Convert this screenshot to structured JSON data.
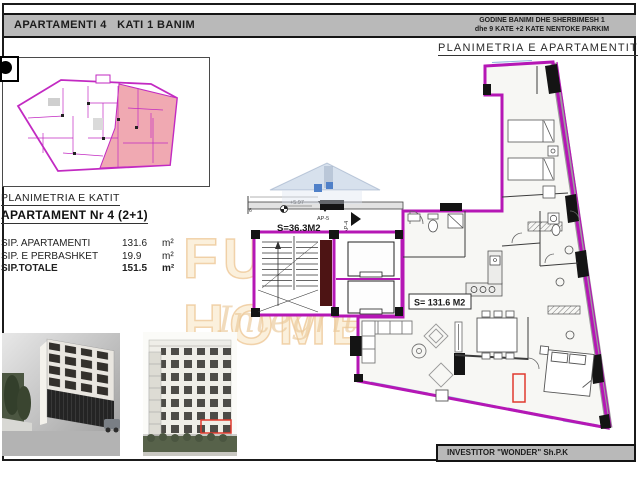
{
  "header": {
    "left_title": "APARTAMENTI 4   KATI 1 BANIM",
    "right_line1": "GODINE BANIMI DHE SHERBIMESH 1",
    "right_line2": "dhe 9 KATE +2 KATE NENTOKE PARKIM"
  },
  "titles": {
    "apartment_plan": "PLANIMETRIA E APARTAMENTIT",
    "key_plan": "PLANIMETRIA E KATIT",
    "apartment_heading": "APARTAMENT Nr 4  (2+1)"
  },
  "areas": {
    "rows": [
      {
        "label": "SIP. APARTAMENTI",
        "value": "131.6",
        "unit": "m²"
      },
      {
        "label": "SIP. E PERBASHKET",
        "value": "19.9",
        "unit": "m²"
      },
      {
        "label": "SIP.TOTALE",
        "value": "151.5",
        "unit": "m²"
      }
    ]
  },
  "plan_labels": {
    "common_area": "S=36.3M2",
    "apartment_area": "S= 131.6 M2",
    "level_mark": "+5.97",
    "ap5": "AP-5",
    "ap4": "AP-4",
    "grid_axis": "6"
  },
  "watermark": {
    "name": "FUTURE HOME",
    "tagline": "Integrity"
  },
  "footer": {
    "investor": "INVESTITOR \"WONDER\" Sh.P.K"
  },
  "colors": {
    "wall_magenta": "#b517b5",
    "key_plan_pink": "#f0a9b2",
    "window_blue": "#8fb6dd",
    "highlight_red": "#e03a2e",
    "bar_gray": "#b9b9b9",
    "watermark_tan": "#f0d2a6",
    "logo_blue": "#4f80c8"
  }
}
